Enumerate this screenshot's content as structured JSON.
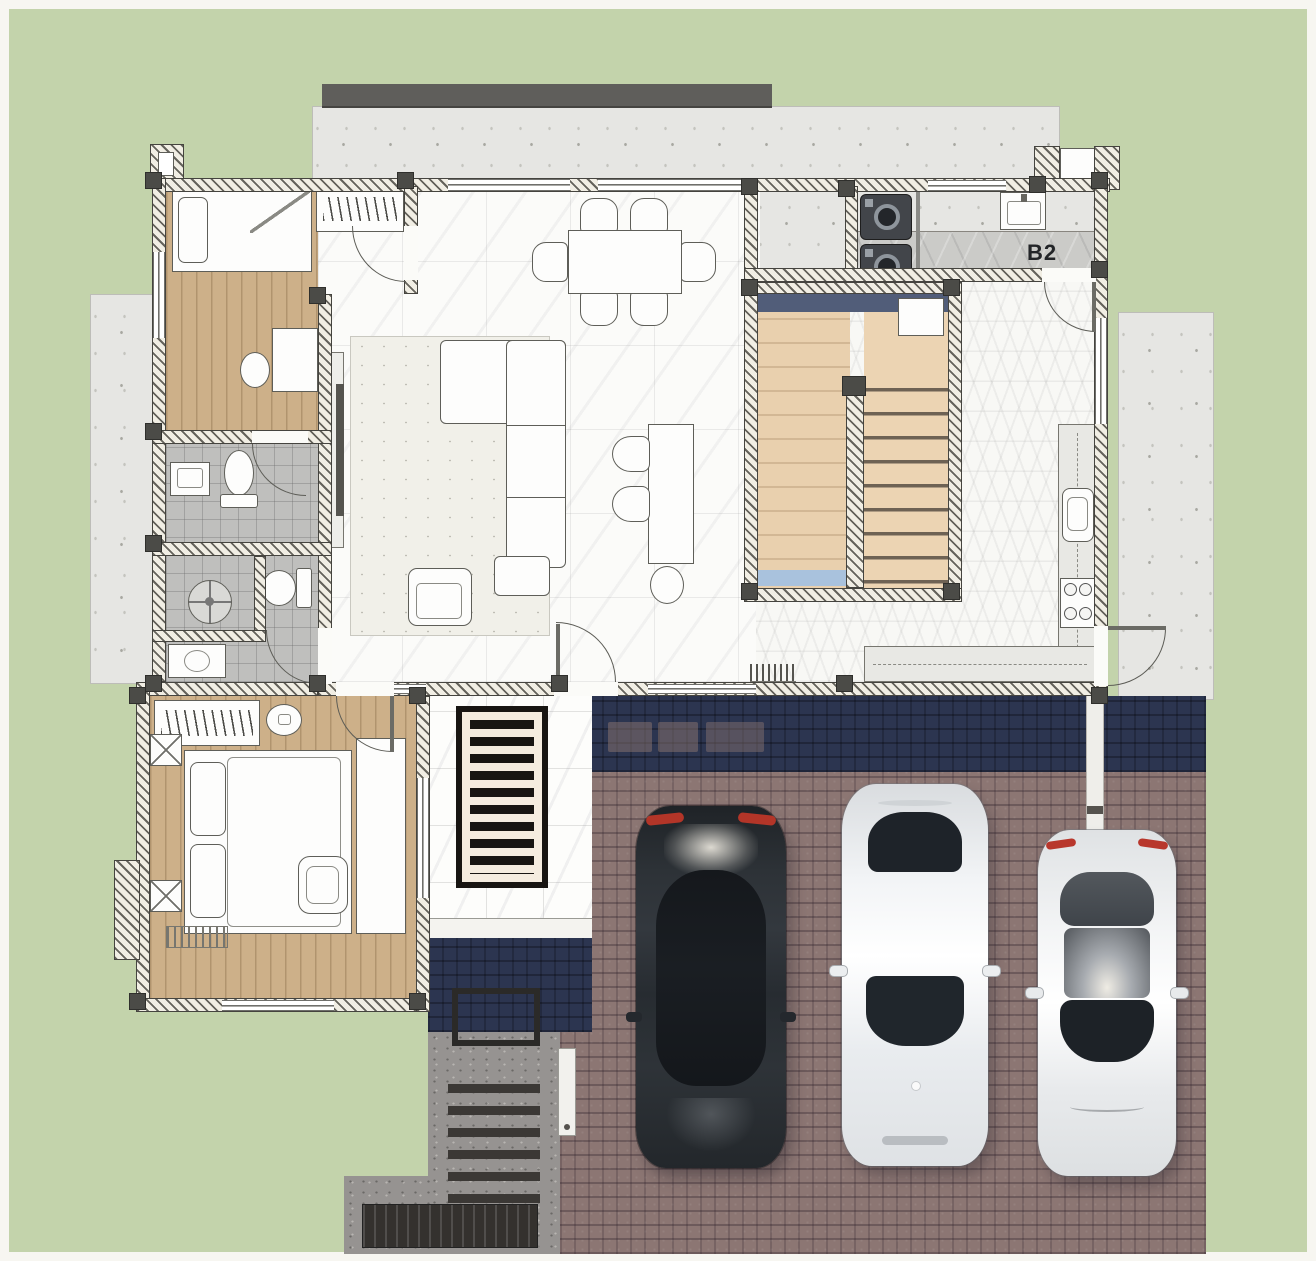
{
  "plan": {
    "type": "architectural-floor-plan-top-view",
    "room_labels": {
      "utility": "B2"
    },
    "colors": {
      "background": "#f7f6f1",
      "grass": "#c3d3ab",
      "wood": "#cdb089",
      "stair_wood": "#e9d0ae",
      "marble": "#fbfbf9",
      "tile": "#bfbfbd",
      "concrete": "#e6e6e3",
      "roof": "#5f5e5b",
      "brick": "#8c7673",
      "shadow_navy": "#2c3550",
      "stair_landing_navy": "#515d79",
      "stair_blue": "#a9c2dd",
      "mat_black": "#181512",
      "mat_cream": "#f5ecdf",
      "walkway": "#969391",
      "step_dark": "#3b3835",
      "taillight_red": "#b33528",
      "car_dark": "#2b3036",
      "car_white": "#eceef0"
    },
    "rooms": [
      "bedroom-1",
      "hallway",
      "bathroom-1",
      "bathroom-2",
      "living-room",
      "dining-area",
      "utility-room-B2",
      "kitchen",
      "staircase",
      "bedroom-2",
      "entry-porch",
      "upper-deck",
      "left-patio",
      "right-patio",
      "driveway",
      "front-walkway"
    ],
    "fixtures": [
      "single-bed",
      "closet-with-hangers",
      "dresser",
      "stool",
      "toilet",
      "wall-sink",
      "shower-drain",
      "vanity-sink",
      "tv-console",
      "tv",
      "l-shaped-sofa",
      "ottoman",
      "desk",
      "desk-chairs",
      "dining-table",
      "washing-machines",
      "utility-sink",
      "kitchen-counter",
      "kitchen-sink",
      "gas-stove",
      "double-bed",
      "wardrobe-with-hangers",
      "nightstands",
      "armchair",
      "bench",
      "doormat",
      "planter-outline",
      "drain-grate"
    ],
    "counts": {
      "dining_chairs": 6,
      "washing_machines": 2,
      "stove_burners": 4,
      "parked_cars": 3,
      "entry_steps": 6,
      "doormat_bars": 10,
      "stair_tread_lines": 8
    },
    "cars": [
      {
        "name": "dark-sedan",
        "color": "#2b3036"
      },
      {
        "name": "white-sedan",
        "color": "#eceef0"
      },
      {
        "name": "white-hatchback",
        "color": "#e9ebec"
      }
    ]
  }
}
